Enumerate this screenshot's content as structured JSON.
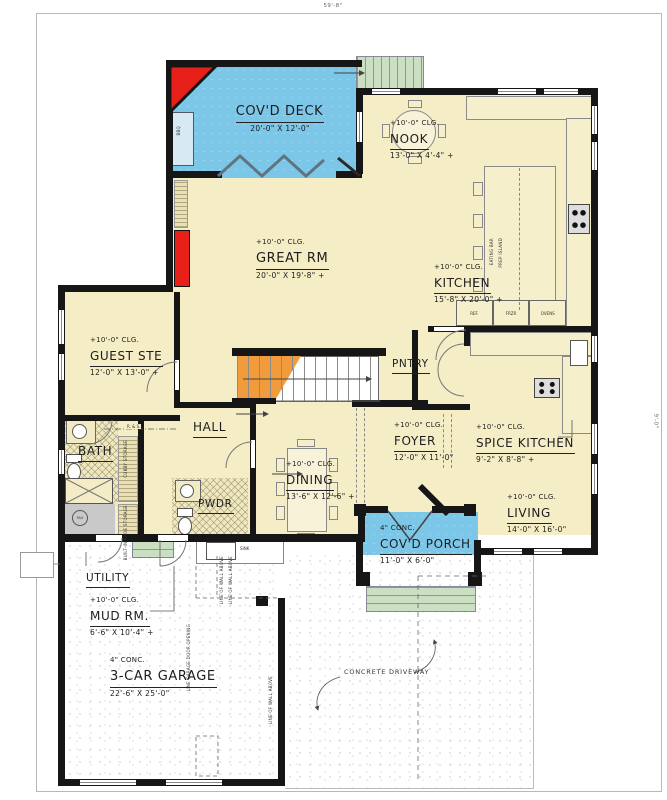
{
  "dimensions": {
    "top_width": "59'-8\"",
    "right_height": "9'-0\""
  },
  "rooms": {
    "covd_deck": {
      "name": "COV'D DECK",
      "dims": "20'-0\" X 12'-0\""
    },
    "nook": {
      "clg": "+10'-0\" CLG.",
      "name": "NOOK",
      "dims": "13'-0\" X 4'-4\" +"
    },
    "great_rm": {
      "clg": "+10'-0\" CLG.",
      "name": "GREAT RM",
      "dims": "20'-0\" X 19'-8\" +"
    },
    "kitchen": {
      "clg": "+10'-0\" CLG.",
      "name": "KITCHEN",
      "dims": "15'-8\" X 20'-0\" +"
    },
    "guest_ste": {
      "clg": "+10'-0\" CLG.",
      "name": "GUEST STE",
      "dims": "12'-0\" X 13'-0\" +"
    },
    "pntry": {
      "name": "PNTRY"
    },
    "hall": {
      "name": "HALL"
    },
    "bath": {
      "name": "BATH"
    },
    "foyer": {
      "clg": "+10'-0\" CLG.",
      "name": "FOYER",
      "dims": "12'-0\" X 11'-0\""
    },
    "spice_kitchen": {
      "clg": "+10'-0\" CLG.",
      "name": "SPICE KITCHEN",
      "dims": "9'-2\" X 8'-8\" +"
    },
    "dining": {
      "clg": "+10'-0\" CLG.",
      "name": "DINING",
      "dims": "13'-6\" X 12'-6\" +"
    },
    "pwdr": {
      "name": "PWDR"
    },
    "living": {
      "clg": "+10'-0\" CLG.",
      "name": "LIVING",
      "dims": "14'-0\" X 16'-0\""
    },
    "covd_porch": {
      "note": "4\" CONC.",
      "name": "COV'D PORCH",
      "dims": "11'-0\" X 6'-0\""
    },
    "utility": {
      "name": "UTILITY"
    },
    "mud_rm": {
      "clg": "+10'-0\" CLG.",
      "name": "MUD RM.",
      "dims": "6'-6\" X 10'-4\" +"
    },
    "garage": {
      "note": "4\" CONC.",
      "name": "3-CAR GARAGE",
      "dims": "22'-6\" X 25'-0\""
    },
    "driveway": {
      "name": "CONCRETE DRIVEWAY"
    }
  },
  "fixtures": {
    "ref": "REF.",
    "frzr": "FRZR",
    "ovens": "OVENS",
    "sink": "SINK",
    "fau": "FAU",
    "bbq": "BBQ",
    "eating_bar": "EATING BAR",
    "prep_island": "PREP ISLAND",
    "cubby_storage": "CUBBY STORAGE",
    "shoe_storage": "BUILT-IN SHOE STORAGE",
    "rod_shelf": "R. & S.",
    "line_of_wall_above": "LINE OF WALL ABOVE",
    "line_garage_door": "LINE GARAGE DOOR OPENING"
  },
  "colors": {
    "floor": "#F5EDC6",
    "deck": "#7CC6E8",
    "steps": "#CBDFC3",
    "stair_accent": "#F29B3C",
    "fireplace": "#E8201A",
    "wall": "#161616",
    "pad": "#C9C9C9"
  }
}
